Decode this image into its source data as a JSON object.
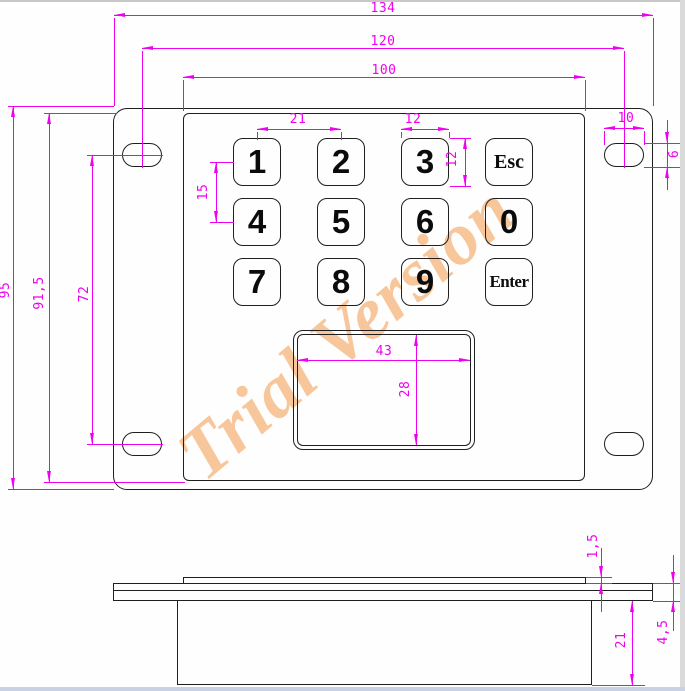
{
  "watermark": "Trial Version",
  "colors": {
    "dimension": "#f000f0",
    "line": "#1f1f1f",
    "watermark": "#f7c69a"
  },
  "keypad": {
    "rows": [
      {
        "keys": [
          "1",
          "2",
          "3",
          "Esc"
        ]
      },
      {
        "keys": [
          "4",
          "5",
          "6",
          "0"
        ]
      },
      {
        "keys": [
          "7",
          "8",
          "9",
          "Enter"
        ]
      }
    ]
  },
  "dimensions": {
    "overall_width": "134",
    "hole_span_width": "120",
    "face_width": "100",
    "overall_height": "95",
    "face_height": "91,5",
    "hole_span_height": "72",
    "key_pitch_x": "21",
    "key_pitch_y": "15",
    "key_width": "12",
    "key_height": "12",
    "hole_width": "10",
    "hole_height": "6",
    "touchpad_width": "43",
    "touchpad_height": "28",
    "face_thickness": "1,5",
    "plate_thickness": "4,5",
    "enclosure_depth": "21"
  }
}
